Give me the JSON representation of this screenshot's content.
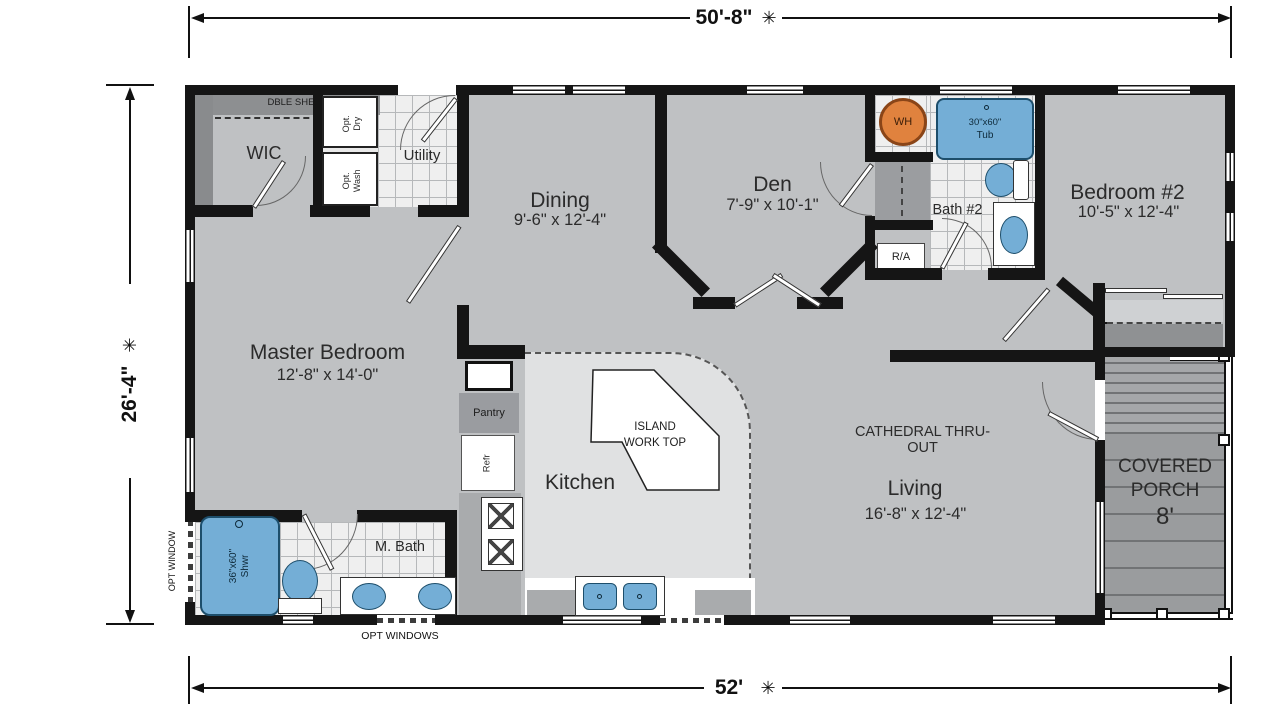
{
  "plan": {
    "dimensions": {
      "top": {
        "value": "50'-8\"",
        "star": "✳"
      },
      "left": {
        "value": "26'-4\"",
        "star": "✳"
      },
      "bottom": {
        "value": "52'",
        "star": "✳"
      }
    },
    "rooms": {
      "wic": {
        "name": "WIC"
      },
      "utility": {
        "name": "Utility"
      },
      "dining": {
        "name": "Dining",
        "dims": "9'-6\" x 12'-4\""
      },
      "den": {
        "name": "Den",
        "dims": "7'-9\" x 10'-1\""
      },
      "bath2": {
        "name": "Bath #2"
      },
      "bedroom2": {
        "name": "Bedroom #2",
        "dims": "10'-5\" x 12'-4\""
      },
      "master_bedroom": {
        "name": "Master Bedroom",
        "dims": "12'-8\" x 14'-0\""
      },
      "kitchen": {
        "name": "Kitchen"
      },
      "living": {
        "name": "Living",
        "dims": "16'-8\" x 12'-4\""
      },
      "master_bath": {
        "name": "M. Bath"
      },
      "covered_porch": {
        "word1": "COVERED",
        "word2": "PORCH",
        "size": "8'"
      }
    },
    "features": {
      "dble_shelf": "DBLE SHELF",
      "opt_dry_line1": "Opt.",
      "opt_dry_line2": "Dry",
      "opt_wash_line1": "Opt.",
      "opt_wash_line2": "Wash",
      "water_heater": "WH",
      "tub_size": "30\"x60\"",
      "tub": "Tub",
      "return_air": "R/A",
      "pantry": "Pantry",
      "refrigerator": "Refr",
      "island_line1": "ISLAND",
      "island_line2": "WORK TOP",
      "cathedral": "CATHEDRAL THRU-OUT",
      "shower_size": "36\"x60\"",
      "shower": "Shwr",
      "opt_window": "OPT WINDOW",
      "opt_windows": "OPT WINDOWS"
    },
    "colors": {
      "floor": "#bfc1c3",
      "porch_deck": "#9a9c9e",
      "tile": "#efefef",
      "fixture_blue": "#74aed6",
      "water_heater_orange": "#e0823e",
      "wall": "#151515"
    }
  }
}
